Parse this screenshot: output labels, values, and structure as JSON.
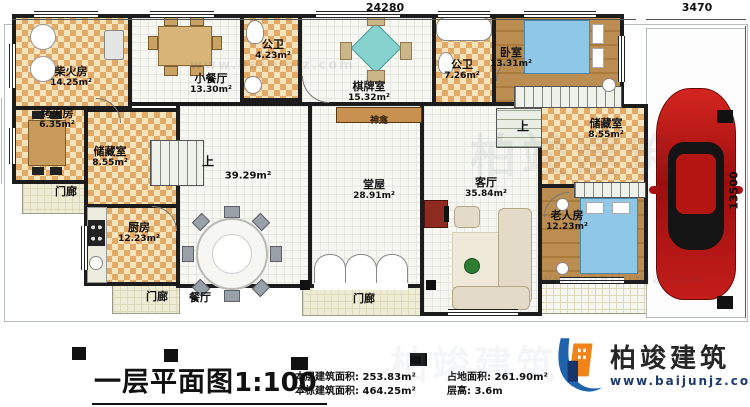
{
  "dimensions": {
    "top": "24280",
    "top_right": "3470",
    "right": "13500"
  },
  "rooms": {
    "chaihuofang": {
      "name": "柴火房",
      "area": "14.25m²"
    },
    "xiaocanting": {
      "name": "小餐厅",
      "area": "13.30m²"
    },
    "gongwei1": {
      "name": "公卫",
      "area": "4.23m²"
    },
    "qipaishi": {
      "name": "棋牌室",
      "area": "15.32m²"
    },
    "gongwei2": {
      "name": "公卫",
      "area": "7.26m²"
    },
    "woshi": {
      "name": "卧室",
      "area": "13.31m²"
    },
    "kaohuofang": {
      "name": "烤火房",
      "area": "6.35m²"
    },
    "chucang_left": {
      "name": "储藏室",
      "area": "8.55m²"
    },
    "chufang": {
      "name": "厨房",
      "area": "12.23m²"
    },
    "canting": {
      "name": "餐厅",
      "area": "39.29m²"
    },
    "tangwu": {
      "name": "堂屋",
      "area": "28.91m²"
    },
    "keting": {
      "name": "客厅",
      "area": "35.84m²"
    },
    "chucang_right": {
      "name": "储藏室",
      "area": "8.55m²"
    },
    "laorenfang": {
      "name": "老人房",
      "area": "12.23m²"
    }
  },
  "labels": {
    "shrine": "神龛",
    "porch_west": "门廊",
    "porch_south_left": "门廊",
    "porch_south_center": "门廊",
    "stairs_up_left": "上",
    "stairs_up_right": "上"
  },
  "footer": {
    "plan_title": "一层平面图",
    "plan_scale": "1:100",
    "stats_left": [
      {
        "label": "本层建筑面积:",
        "value": "253.83m²"
      },
      {
        "label": "本栋建筑面积:",
        "value": "464.25m²"
      }
    ],
    "stats_right": [
      {
        "label": "占地面积:",
        "value": "261.90m²"
      },
      {
        "label": "层高:",
        "value": "3.6m"
      }
    ]
  },
  "logo": {
    "name": "柏竣建筑",
    "url": "www.baijunjz.com"
  },
  "watermark": {
    "brand": "柏竣建筑",
    "url": "www.baijunjz.com"
  },
  "colors": {
    "wall": "#1c1c1c",
    "checker": "#e3a966",
    "car": "#c01d18",
    "logo_blue": "#1f63ad",
    "logo_orange": "#f08419"
  }
}
